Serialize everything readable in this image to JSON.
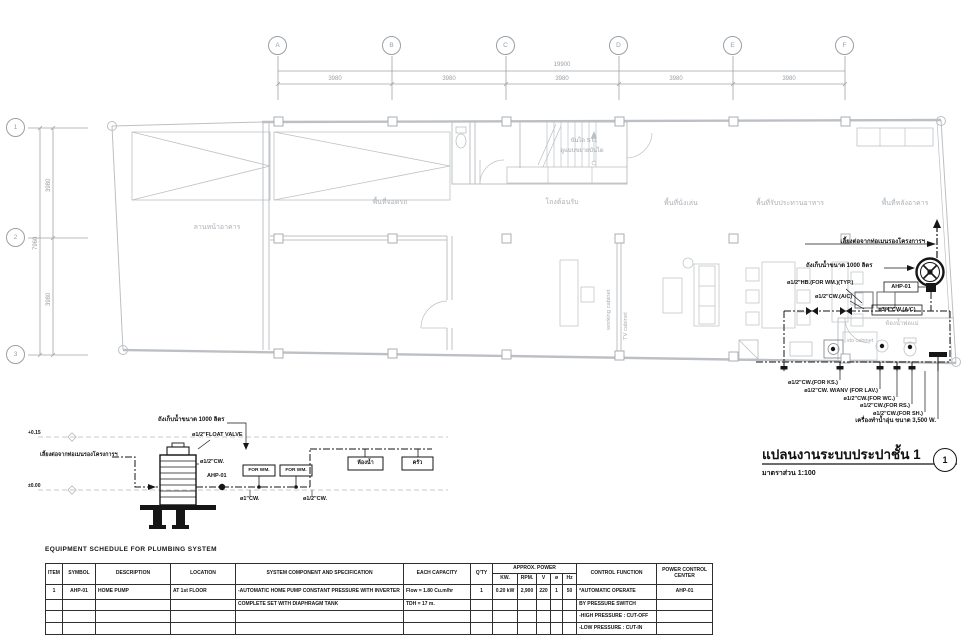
{
  "grid": {
    "cols": [
      "A",
      "B",
      "C",
      "D",
      "E",
      "F"
    ],
    "rows": [
      "1",
      "2",
      "3"
    ],
    "total_width": "19900",
    "bay_width": "3980",
    "total_depth": "7960",
    "bay_depth": "3980"
  },
  "rooms": {
    "front_yard": "ลานหน้าอาคาร",
    "parking": "พื้นที่จอดรถ",
    "reception": "โถงต้อนรับ",
    "living": "พื้นที่นั่งเล่น",
    "dining": "พื้นที่รับประทานอาหาร",
    "back_area": "พื้นที่หลังอาคาร",
    "bathroom": "ห้องน้ำพ่อแม่",
    "stair_name": "บันได ST1",
    "stair_ref": "ดูแบบขยายบันได",
    "working_cabinet": "working cabinet",
    "tv_cabinet": "TV cabinet",
    "sto_cabinet": "sto cabinet"
  },
  "plumbing": {
    "main_tap": "เลี้ยงต่อจากท่อเมนรองโครงการฯ",
    "tank": "ถังเก็บน้ำขนาด 1000 ลิตร",
    "hb_wm": "ø1/2\"HB.(FOR WM.)(TYP.)",
    "pump_tag": "AHP-01",
    "cw_ac_half": "ø1/2\"CW.(A/C)",
    "cw_ac_34": "ø3/4\"CW.(A/C)",
    "cw_ks": "ø1/2\"CW.(FOR KS.)",
    "cw_lav": "ø1/2\"CW. W/ANV (FOR LAV.)",
    "cw_wc": "ø1/2\"CW.(FOR WC.)",
    "cw_rs": "ø1/2\"CW.(FOR RS.)",
    "cw_sh": "ø1/2\"CW.(FOR SH.)",
    "heater": "เครื่องทำน้ำอุ่น ขนาด 3,500 W."
  },
  "detail": {
    "tank_label": "ถังเก็บน้ำขนาด 1000 ลิตร",
    "float_valve": "ø1/2\"FLOAT VALVE",
    "cw_outlet": "ø1/2\"CW.",
    "inlet_note": "เลี้ยงต่อจากท่อเมนรองโครงการฯ",
    "pump_tag": "AHP-01",
    "box_wm1": "FOR WM.",
    "box_wm2": "FOR WM.",
    "box_bath": "ห้องน้ำ",
    "box_kitchen": "ครัว",
    "pipe1": "ø1\"CW.",
    "pipe2": "ø1/2\"CW.",
    "level_top": "+0.15",
    "level_bottom": "±0.00"
  },
  "titleblock": {
    "title": "แปลนงานระบบประปาชั้น 1",
    "scale": "มาตราส่วน 1:100",
    "ref": "1"
  },
  "schedule": {
    "title": "EQUIPMENT SCHEDULE FOR PLUMBING SYSTEM",
    "col_item": "ITEM",
    "col_symbol": "SYMBOL",
    "col_desc": "DESCRIPTION",
    "col_loc": "LOCATION",
    "col_sys": "SYSTEM COMPONENT AND SPECIFICATION",
    "col_cap": "EACH CAPACITY",
    "col_qty": "Q'TY",
    "col_power": "APPROX. POWER",
    "col_kw": "KW.",
    "col_rpm": "RPM.",
    "col_v": "V",
    "col_ph": "ø",
    "col_hz": "Hz",
    "col_ctrl": "CONTROL FUNCTION",
    "col_pcc": "POWER CONTROL CENTER",
    "r1": {
      "item": "1",
      "symbol": "AHP-01",
      "desc": "HOME PUMP",
      "loc": "AT 1st FLOOR",
      "sys": "-AUTOMATIC HOME PUMP CONSTANT PRESSURE WITH INVERTER",
      "cap": "Flow = 1.80 Cu.m/hr",
      "qty": "1",
      "kw": "0.20 kW",
      "rpm": "2,900",
      "v": "220",
      "ph": "1",
      "hz": "50",
      "ctrl": "*AUTOMATIC OPERATE",
      "pcc": "AHP-01"
    },
    "r2": {
      "sys": "COMPLETE SET WITH DIAPHRAGM TANK",
      "cap": "TDH = 17 m.",
      "ctrl": "BY PRESSURE SWITCH"
    },
    "r3": {
      "ctrl": "-HIGH PRESSURE : CUT-OFF"
    },
    "r4": {
      "ctrl": "-LOW PRESSURE : CUT-IN"
    }
  }
}
